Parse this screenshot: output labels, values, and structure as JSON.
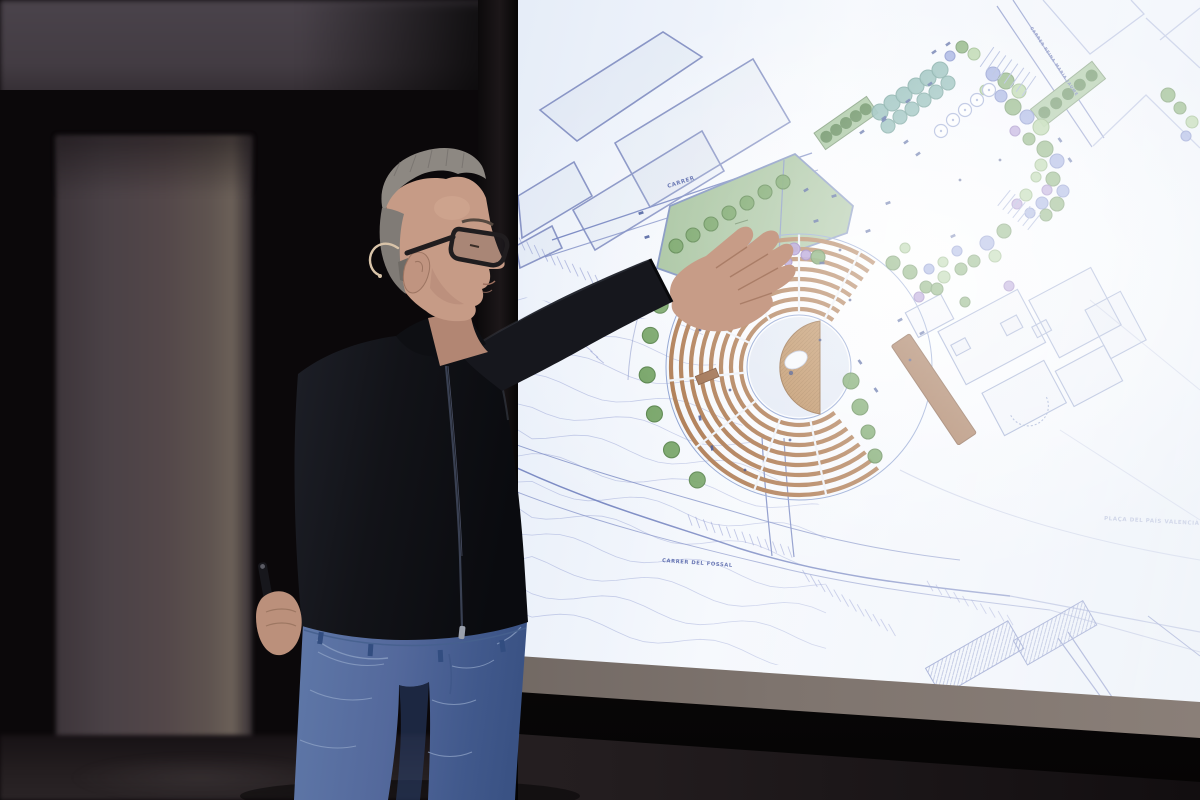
{
  "screen_labels": {
    "street_top": "CARRER",
    "street_top_right": "CARRER REINA MARIA JAUME",
    "street_bottom": "CARRER DEL FOSSAL",
    "placa": "PLAÇA DEL PAÍS VALENCIÀ"
  },
  "palette": {
    "screen_paper": "#e6edf8",
    "plan_line": "#7d8cc4",
    "lawn_green": "#a6c39e",
    "seat_brown": "#ad7950",
    "stage_tan": "#bd8f5f",
    "walk_brown": "#9c6b49",
    "jacket_black": "#14151b",
    "denim_blue": "#54699c",
    "skin": "#c69b86",
    "hair_gray": "#8d8882",
    "room_dark": "#0b080a",
    "pillar_gray": "#534749"
  },
  "plan": {
    "parcels": {
      "p1": "615,143 753,59 790,122 650,207",
      "p2": "573,210 702,131 724,171 595,250",
      "p3": "540,110 663,32 702,57 577,141",
      "p4": "518,196 574,162 592,196 522,238",
      "p5": "516,246 552,226 562,248 520,268"
    },
    "field_points": "657,268 670,206 795,154 853,206 847,233 702,284",
    "amph": {
      "cx": 799,
      "cy": 367,
      "radii": [
        128,
        118,
        108,
        98,
        88,
        78,
        68,
        58
      ],
      "a0": 52,
      "a1": 306,
      "seat": "#ad7950",
      "sw": 4.2,
      "aisles": [
        78,
        110,
        142,
        174,
        206,
        238,
        270,
        298
      ],
      "rin": 54,
      "rout": 133
    },
    "treeArc": {
      "cx": 799,
      "cy": 367,
      "r": 152,
      "angles": [
        132,
        147,
        162,
        177,
        192,
        204
      ],
      "tr": 8,
      "c": "g"
    },
    "treeColors": {
      "g": "#6fa05e",
      "lg": "#a5cb93",
      "b": "#8d9edb",
      "p": "#a78fd1",
      "t": "#7fb2ad"
    },
    "treeStrokes": {
      "g": "#4f7d41",
      "lg": "#7ba568",
      "b": "#6677c0",
      "p": "#8468b5",
      "t": "#5d938c"
    },
    "trees": [
      [
        676,
        246,
        7,
        "g"
      ],
      [
        693,
        235,
        7,
        "g"
      ],
      [
        711,
        224,
        7,
        "g"
      ],
      [
        729,
        213,
        7,
        "g"
      ],
      [
        747,
        203,
        7,
        "g"
      ],
      [
        765,
        192,
        7,
        "g"
      ],
      [
        783,
        182,
        7,
        "g"
      ],
      [
        712,
        258,
        4,
        "g"
      ],
      [
        893,
        263,
        7,
        "g"
      ],
      [
        910,
        272,
        7,
        "g"
      ],
      [
        926,
        287,
        6,
        "g"
      ],
      [
        943,
        262,
        5,
        "lg"
      ],
      [
        905,
        248,
        5,
        "lg"
      ],
      [
        851,
        381,
        8,
        "g"
      ],
      [
        860,
        407,
        8,
        "g"
      ],
      [
        868,
        432,
        7,
        "g"
      ],
      [
        875,
        456,
        7,
        "g"
      ],
      [
        781,
        253,
        6,
        "p"
      ],
      [
        794,
        249,
        6,
        "p"
      ],
      [
        806,
        255,
        5,
        "p"
      ],
      [
        788,
        262,
        4,
        "p"
      ],
      [
        818,
        257,
        7,
        "g"
      ],
      [
        880,
        112,
        8,
        "t"
      ],
      [
        892,
        103,
        8,
        "t"
      ],
      [
        904,
        95,
        8,
        "t"
      ],
      [
        916,
        86,
        8,
        "t"
      ],
      [
        928,
        78,
        8,
        "t"
      ],
      [
        940,
        70,
        8,
        "t"
      ],
      [
        888,
        126,
        7,
        "t"
      ],
      [
        900,
        117,
        7,
        "t"
      ],
      [
        912,
        109,
        7,
        "t"
      ],
      [
        924,
        100,
        7,
        "t"
      ],
      [
        936,
        92,
        7,
        "t"
      ],
      [
        948,
        83,
        7,
        "t"
      ],
      [
        962,
        47,
        6,
        "g"
      ],
      [
        974,
        54,
        6,
        "lg"
      ],
      [
        950,
        56,
        5,
        "b"
      ],
      [
        993,
        74,
        7,
        "b"
      ],
      [
        1006,
        81,
        8,
        "g"
      ],
      [
        1019,
        91,
        7,
        "lg"
      ],
      [
        1001,
        96,
        6,
        "b"
      ],
      [
        985,
        90,
        5,
        "lg"
      ],
      [
        1013,
        107,
        8,
        "g"
      ],
      [
        1027,
        117,
        7,
        "b"
      ],
      [
        1041,
        127,
        8,
        "lg"
      ],
      [
        1029,
        139,
        6,
        "g"
      ],
      [
        1015,
        131,
        5,
        "p"
      ],
      [
        1045,
        149,
        8,
        "g"
      ],
      [
        1057,
        161,
        7,
        "b"
      ],
      [
        1041,
        165,
        6,
        "lg"
      ],
      [
        1053,
        179,
        7,
        "g"
      ],
      [
        1063,
        191,
        6,
        "b"
      ],
      [
        1047,
        190,
        5,
        "p"
      ],
      [
        1036,
        177,
        5,
        "lg"
      ],
      [
        1057,
        204,
        7,
        "g"
      ],
      [
        1042,
        203,
        6,
        "b"
      ],
      [
        1026,
        195,
        6,
        "lg"
      ],
      [
        1046,
        215,
        6,
        "g"
      ],
      [
        1030,
        213,
        5,
        "b"
      ],
      [
        1017,
        204,
        5,
        "p"
      ],
      [
        1004,
        231,
        7,
        "g"
      ],
      [
        987,
        243,
        7,
        "b"
      ],
      [
        995,
        256,
        6,
        "lg"
      ],
      [
        974,
        261,
        6,
        "g"
      ],
      [
        957,
        251,
        5,
        "b"
      ],
      [
        961,
        269,
        6,
        "g"
      ],
      [
        944,
        277,
        6,
        "lg"
      ],
      [
        929,
        269,
        5,
        "b"
      ],
      [
        937,
        289,
        6,
        "g"
      ],
      [
        919,
        297,
        5,
        "p"
      ],
      [
        1009,
        286,
        5,
        "p"
      ],
      [
        965,
        302,
        5,
        "g"
      ],
      [
        1168,
        95,
        7,
        "g"
      ],
      [
        1180,
        108,
        6,
        "g"
      ],
      [
        1192,
        122,
        6,
        "lg"
      ],
      [
        1186,
        136,
        5,
        "b"
      ]
    ],
    "planters": [
      [
        941,
        131
      ],
      [
        953,
        120
      ],
      [
        965,
        110
      ],
      [
        977,
        100
      ],
      [
        989,
        90
      ]
    ],
    "hedges": [
      {
        "cx": 846,
        "cy": 123,
        "w": 64,
        "h": 20,
        "rot": -35,
        "dots": [
          -24,
          -12,
          0,
          12,
          24
        ]
      },
      {
        "cx": 1068,
        "cy": 94,
        "w": 78,
        "h": 22,
        "rot": -38,
        "dots": [
          -30,
          -15,
          0,
          15,
          30
        ]
      }
    ],
    "stairs": [
      {
        "x1": 987,
        "y1": 57,
        "x2": 1029,
        "y2": 86,
        "n": 8,
        "len": 24
      },
      {
        "x1": 1004,
        "y1": 198,
        "x2": 1034,
        "y2": 222,
        "n": 7,
        "len": 20
      }
    ],
    "marks": [
      [
        641,
        213,
        -18
      ],
      [
        647,
        237,
        -18
      ],
      [
        816,
        221,
        -18
      ],
      [
        834,
        196,
        -18
      ],
      [
        806,
        190,
        -30
      ],
      [
        862,
        132,
        -35
      ],
      [
        884,
        118,
        -35
      ],
      [
        906,
        142,
        -35
      ],
      [
        918,
        154,
        -35
      ],
      [
        934,
        52,
        -35
      ],
      [
        948,
        44,
        -35
      ],
      [
        868,
        231,
        -20
      ],
      [
        888,
        203,
        -20
      ],
      [
        953,
        236,
        -25
      ],
      [
        900,
        320,
        -28
      ],
      [
        922,
        333,
        -28
      ],
      [
        822,
        263,
        0
      ],
      [
        744,
        296,
        10
      ],
      [
        700,
        418,
        80
      ],
      [
        712,
        448,
        80
      ],
      [
        860,
        362,
        55
      ],
      [
        876,
        390,
        55
      ],
      [
        884,
        120,
        -35
      ],
      [
        908,
        101,
        -35
      ],
      [
        930,
        84,
        -35
      ],
      [
        1060,
        140,
        55
      ],
      [
        1070,
        160,
        55
      ]
    ],
    "dots": [
      [
        760,
        300
      ],
      [
        820,
        340
      ],
      [
        850,
        300
      ],
      [
        730,
        390
      ],
      [
        790,
        440
      ],
      [
        910,
        360
      ],
      [
        840,
        250
      ],
      [
        960,
        180
      ],
      [
        1000,
        160
      ],
      [
        700,
        330
      ],
      [
        745,
        470
      ]
    ],
    "contours": {
      "x0": 518,
      "x1": 830,
      "yTop": 300,
      "rows": 13,
      "dy": 26,
      "amp": 7
    },
    "contourClip": "518,296 700,328 762,470 905,556 905,665 518,665",
    "hatchBands": [
      {
        "x1": 522,
        "y1": 244,
        "x2": 636,
        "y2": 300,
        "n": 16,
        "len": 14,
        "tilt": 65
      },
      {
        "x1": 690,
        "y1": 520,
        "x2": 790,
        "y2": 552,
        "n": 14,
        "len": 12,
        "tilt": 70
      },
      {
        "x1": 806,
        "y1": 576,
        "x2": 892,
        "y2": 630,
        "n": 12,
        "len": 14,
        "tilt": 60
      },
      {
        "x1": 930,
        "y1": 586,
        "x2": 1010,
        "y2": 620,
        "n": 10,
        "len": 12,
        "tilt": 60
      },
      {
        "x1": 560,
        "y1": 320,
        "x2": 600,
        "y2": 360,
        "n": 8,
        "len": 10,
        "tilt": 40
      }
    ]
  }
}
